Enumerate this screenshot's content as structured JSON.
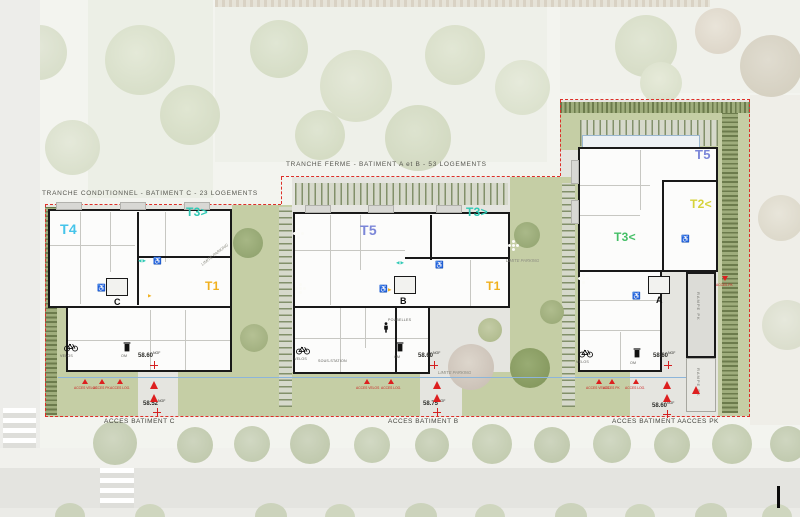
{
  "titles": {
    "tranche_conditionnel": "TRANCHE CONDITIONNEL  -  BATIMENT C  -  23 LOGEMENTS",
    "tranche_ferme": "TRANCHE FERME  -  BATIMENT A et B  -  53 LOGEMENTS"
  },
  "buildings": {
    "c": {
      "core": "C",
      "t4": "T4",
      "t3": "T3>",
      "t1": "T1",
      "velos": "VELOS",
      "om": "OM"
    },
    "b": {
      "core": "B",
      "t5": "T5",
      "t3": "T3>",
      "t1": "T1",
      "velos": "VELOS",
      "om": "OM",
      "poubelles": "POUBELLES",
      "sous_station": "SOUS-STATION"
    },
    "a": {
      "core": "A",
      "t5": "T5",
      "t2": "T2<",
      "t3": "T3<",
      "velos": "VELOS",
      "om": "OM",
      "rampe": "RAMPE PK"
    }
  },
  "access_labels": {
    "c": "ACCES BATIMENT C",
    "b": "ACCES BATIMENT B",
    "a": "ACCES BATIMENT A",
    "pk": "ACCES PK"
  },
  "levels": {
    "unit": "NGF",
    "c_entry": "58.60",
    "c_street": "58.52",
    "b_entry": "58.60",
    "b_street": "58.75",
    "a_entry": "58.60",
    "a_street": "58.60"
  },
  "markers": {
    "velos": "ACCES VELOS",
    "pk": "ACCES PK",
    "log": "ACCES LOG.",
    "ramp": "ACCES PK"
  },
  "annotations": {
    "limite_parking": "LIMITE PARKING"
  },
  "icons": {
    "wheelchair": "♿",
    "arrow_pair": "◀▶",
    "arrow_right": "▶"
  },
  "colors": {
    "t4": "#45c4ea",
    "t5": "#7b86d8",
    "t3_teal": "#2fc9b5",
    "t3_green": "#44bf66",
    "t2": "#d6d23a",
    "t1": "#f0b01e",
    "boundary_red": "#dd2f28",
    "limit_blue": "#8db5da",
    "grass": "#c5cea5"
  }
}
